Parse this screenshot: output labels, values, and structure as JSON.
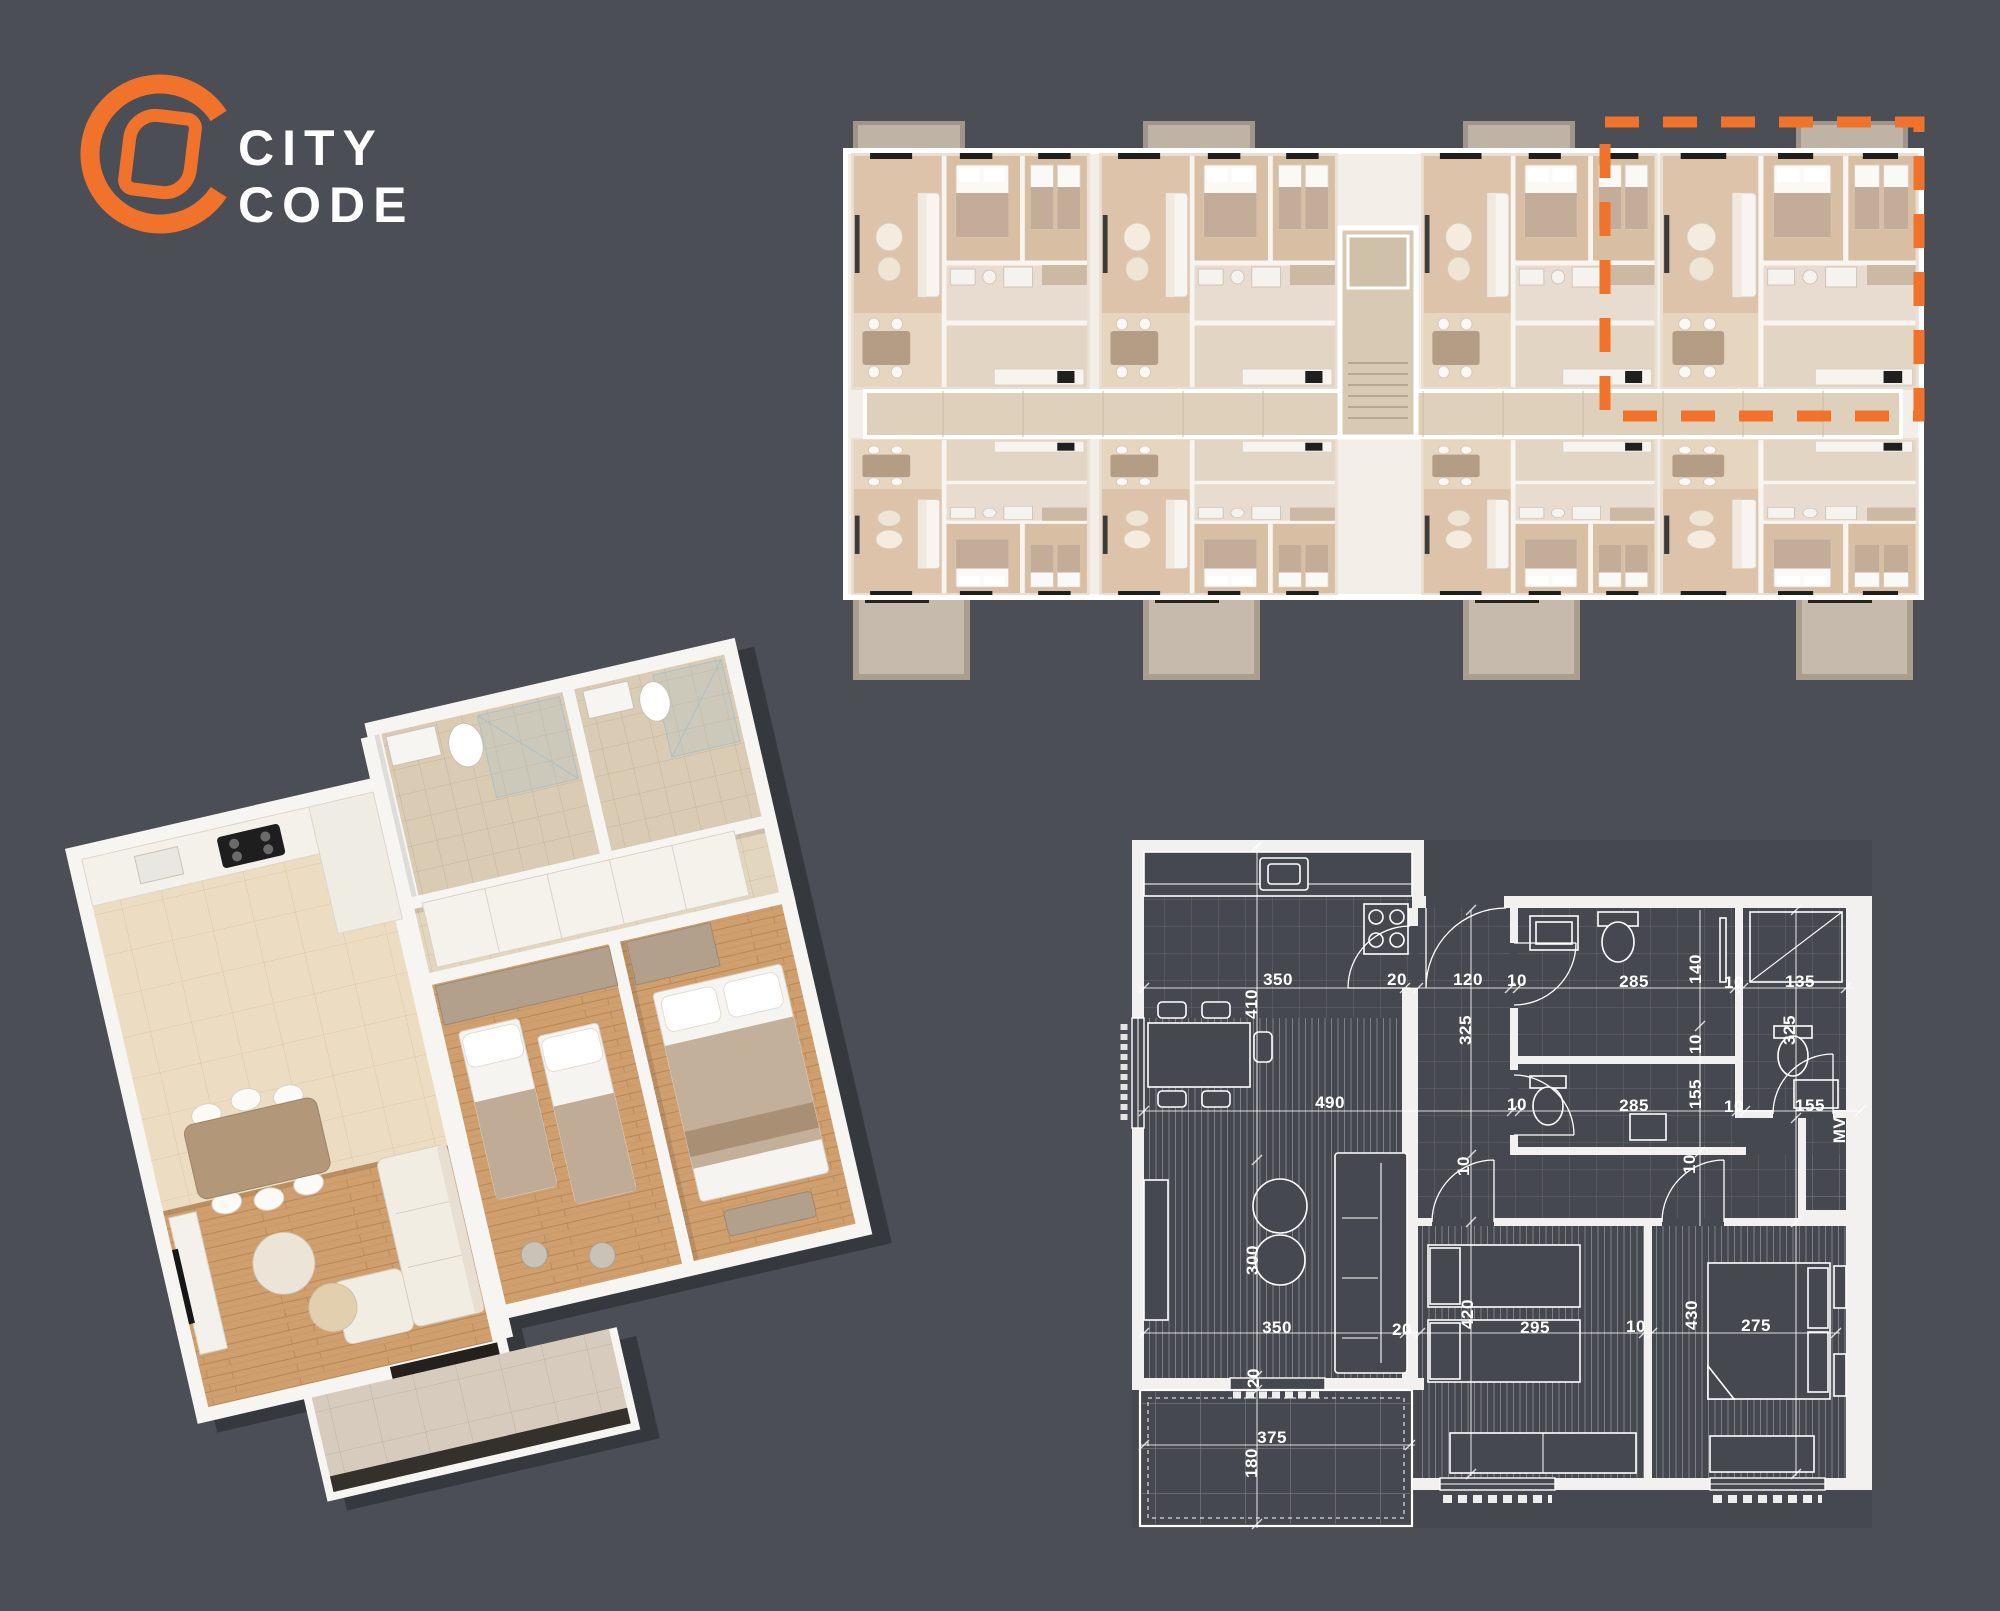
{
  "colors": {
    "background": "#4b4e54",
    "accent": "#f1722b",
    "line": "#ffffff",
    "plan_cream": "#f3eee7",
    "plan_wood": "#dcc3a9",
    "blueprint_room": "#45484e"
  },
  "logo": {
    "line1": "CITY",
    "line2": "CODE"
  },
  "blueprint": {
    "labels": [
      {
        "t": "350",
        "x": 168,
        "y": 162,
        "r": 0
      },
      {
        "t": "410",
        "x": 142,
        "y": 186,
        "r": -90
      },
      {
        "t": "20",
        "x": 287,
        "y": 162,
        "r": 0
      },
      {
        "t": "120",
        "x": 358,
        "y": 162,
        "r": 0
      },
      {
        "t": "10",
        "x": 407,
        "y": 163,
        "r": 0
      },
      {
        "t": "285",
        "x": 524,
        "y": 164,
        "r": 0
      },
      {
        "t": "140",
        "x": 586,
        "y": 151,
        "r": -90
      },
      {
        "t": "10",
        "x": 624,
        "y": 165,
        "r": 0
      },
      {
        "t": "135",
        "x": 690,
        "y": 164,
        "r": 0
      },
      {
        "t": "325",
        "x": 356,
        "y": 212,
        "r": -90
      },
      {
        "t": "325",
        "x": 680,
        "y": 212,
        "r": -90
      },
      {
        "t": "490",
        "x": 220,
        "y": 285,
        "r": 0
      },
      {
        "t": "10",
        "x": 407,
        "y": 287,
        "r": 0
      },
      {
        "t": "285",
        "x": 524,
        "y": 288,
        "r": 0
      },
      {
        "t": "10",
        "x": 586,
        "y": 226,
        "r": -90
      },
      {
        "t": "155",
        "x": 586,
        "y": 276,
        "r": -90
      },
      {
        "t": "10",
        "x": 624,
        "y": 289,
        "r": 0
      },
      {
        "t": "155",
        "x": 700,
        "y": 288,
        "r": 0
      },
      {
        "t": "MV",
        "x": 730,
        "y": 312,
        "r": -90
      },
      {
        "t": "10",
        "x": 354,
        "y": 348,
        "r": -90
      },
      {
        "t": "10",
        "x": 580,
        "y": 346,
        "r": -90
      },
      {
        "t": "300",
        "x": 143,
        "y": 442,
        "r": -90
      },
      {
        "t": "350",
        "x": 167,
        "y": 510,
        "r": 0
      },
      {
        "t": "20",
        "x": 292,
        "y": 512,
        "r": 0
      },
      {
        "t": "295",
        "x": 425,
        "y": 510,
        "r": 0
      },
      {
        "t": "420",
        "x": 358,
        "y": 496,
        "r": -90
      },
      {
        "t": "10",
        "x": 526,
        "y": 509,
        "r": 0
      },
      {
        "t": "430",
        "x": 582,
        "y": 497,
        "r": -90
      },
      {
        "t": "275",
        "x": 646,
        "y": 508,
        "r": 0
      },
      {
        "t": "20",
        "x": 144,
        "y": 560,
        "r": -90
      },
      {
        "t": "375",
        "x": 162,
        "y": 620,
        "r": 0
      },
      {
        "t": "180",
        "x": 142,
        "y": 645,
        "r": -90
      }
    ]
  }
}
